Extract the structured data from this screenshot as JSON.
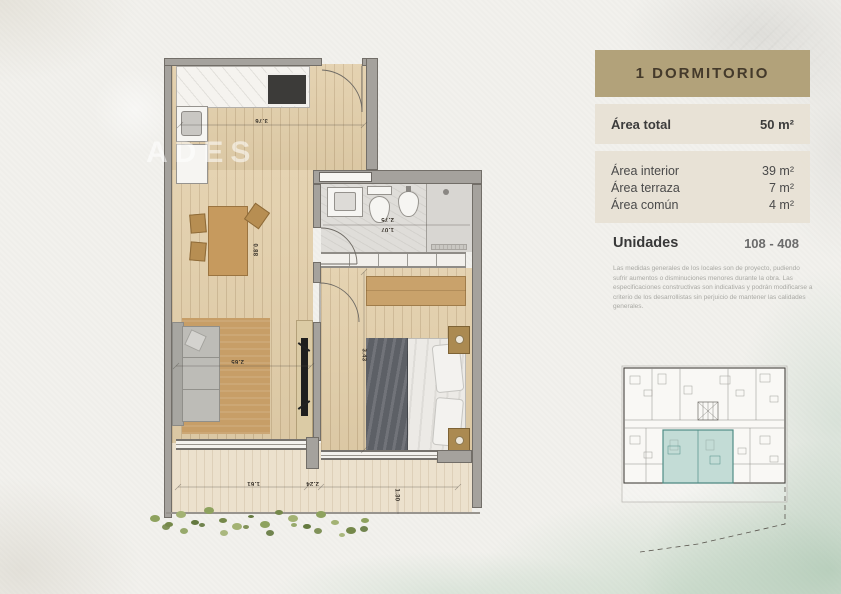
{
  "panel": {
    "title": "1 DORMITORIO",
    "area_total": {
      "label": "Área total",
      "value": "50 m²"
    },
    "areas": [
      {
        "label": "Área interior",
        "value": "39 m²"
      },
      {
        "label": "Área terraza",
        "value": "7 m²"
      },
      {
        "label": "Área común",
        "value": "4 m²"
      }
    ],
    "units": {
      "label": "Unidades",
      "value": "108 - 408"
    },
    "disclaimer": "Las medidas generales de los locales son de proyecto, pudiendo sufrir aumentos o disminuciones menores durante la obra. Las especificaciones constructivas son indicativas y podrán modificarse a criterio de los desarrollistas sin perjuicio de mantener las calidades generales."
  },
  "floorplan": {
    "watermark": "ADES",
    "dimensions": [
      {
        "text": "3.76"
      },
      {
        "text": "0.88"
      },
      {
        "text": "2.75"
      },
      {
        "text": "1.07"
      },
      {
        "text": "2.65"
      },
      {
        "text": "3.43"
      },
      {
        "text": "1.61"
      },
      {
        "text": "2.24"
      },
      {
        "text": "1.30"
      }
    ]
  },
  "keyplan": {
    "highlight_color": "#4f8d85"
  },
  "colors": {
    "accent_tan": "#b2a27a",
    "panel_bg": "#e7e1d4",
    "wall_gray": "#a5a29d",
    "wood": "#e2cea9",
    "teal_fill": "#8dbfb7"
  }
}
